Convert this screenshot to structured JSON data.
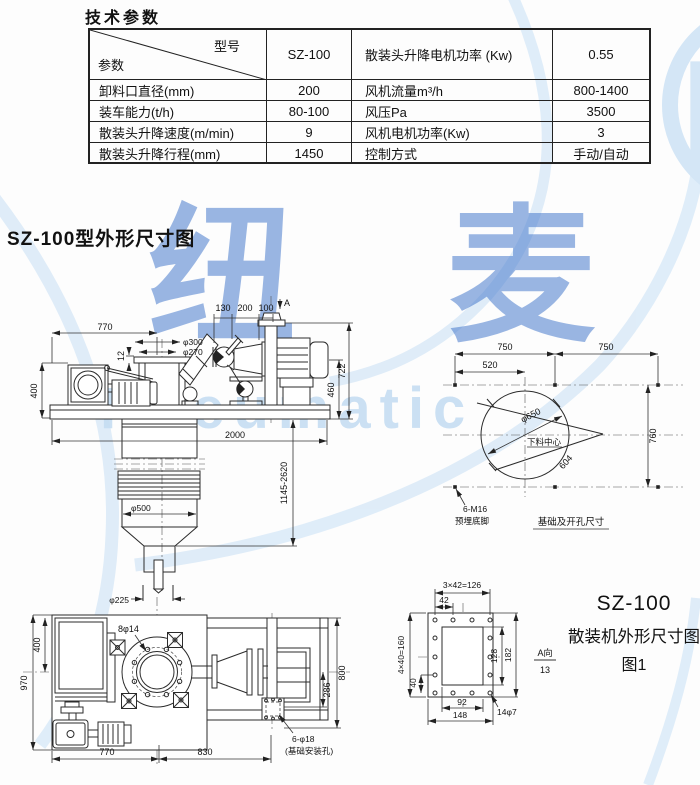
{
  "page": {
    "title": "技术参数",
    "section_title": "SZ-100型外形尺寸图"
  },
  "table": {
    "corner": {
      "top_label": "型号",
      "bottom_label": "参数"
    },
    "header": {
      "model": "SZ-100",
      "param": "散装头升降电机功率 (Kw)",
      "value": "0.55"
    },
    "rows": [
      {
        "p1": "卸料口直径(mm)",
        "v1": "200",
        "p2": "风机流量m³/h",
        "v2": "800-1400"
      },
      {
        "p1": "装车能力(t/h)",
        "v1": "80-100",
        "p2": "风压Pa",
        "v2": "3500"
      },
      {
        "p1": "散装头升降速度(m/min)",
        "v1": "9",
        "p2": "风机电机功率(Kw)",
        "v2": "3"
      },
      {
        "p1": "散装头升降行程(mm)",
        "v1": "1450",
        "p2": "控制方式",
        "v2": "手动/自动"
      }
    ]
  },
  "watermark": {
    "brand_cn": "纽 麦",
    "brand_en": "Pneumatic",
    "logo_letter": "P",
    "accent_blue": "#3f75cb",
    "light_blue": "#cfe3f6"
  },
  "side_view": {
    "d130": "130",
    "d200": "200",
    "d100": "100",
    "view_a": "A",
    "d770": "770",
    "d12": "12",
    "d300": "φ300",
    "d270": "φ270",
    "d400": "400",
    "d722": "722",
    "d460": "460",
    "d2000": "2000",
    "d_stroke": "1145-2620",
    "d500": "φ500"
  },
  "foundation": {
    "d750a": "750",
    "d750b": "750",
    "d520": "520",
    "d650": "φ650",
    "center_label": "下料中心",
    "d604": "604",
    "d760": "760",
    "anchor1": "6-M16",
    "anchor2": "预埋底脚",
    "caption": "基础及开孔尺寸"
  },
  "plan_view": {
    "d225": "φ225",
    "d970": "970",
    "d400": "400",
    "d800": "800",
    "d286": "286",
    "d770": "770",
    "d830": "830",
    "bolts": "8φ14",
    "anchor1": "6-φ18",
    "anchor2": "(基础安装孔)"
  },
  "flange_detail": {
    "dtop": "3×42=126",
    "d42": "42",
    "dleft": "4×40=160",
    "d40": "40",
    "d128": "128",
    "d182": "182",
    "d92": "92",
    "d148": "148",
    "holes": "14φ7",
    "view_dir": "A向",
    "view_num": "13"
  },
  "figure": {
    "model": "SZ-100",
    "name": "散装机外形尺寸图",
    "number": "图1"
  }
}
